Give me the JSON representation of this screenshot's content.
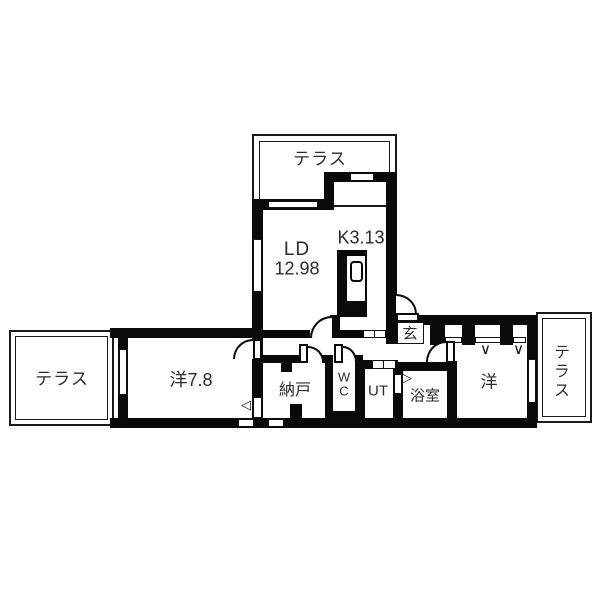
{
  "plan": {
    "title": "apartment-floor-plan",
    "rooms": {
      "terrace_top": "テラス",
      "terrace_left": "テラス",
      "terrace_right": "テラス",
      "living_dining": "LD",
      "living_dining_size": "12.98",
      "kitchen": "K3.13",
      "entrance": "玄",
      "west_room_left": "洋7.8",
      "storage": "納戸",
      "toilet": "WC",
      "utility": "UT",
      "bathroom": "浴室",
      "west_room_right": "洋"
    },
    "marks": {
      "window_v": "∨",
      "tri_left": "◁",
      "tri_right": "▷"
    },
    "colors": {
      "wall": "#0a0a0a",
      "floor": "#ffffff",
      "text": "#2b2b2b"
    }
  }
}
